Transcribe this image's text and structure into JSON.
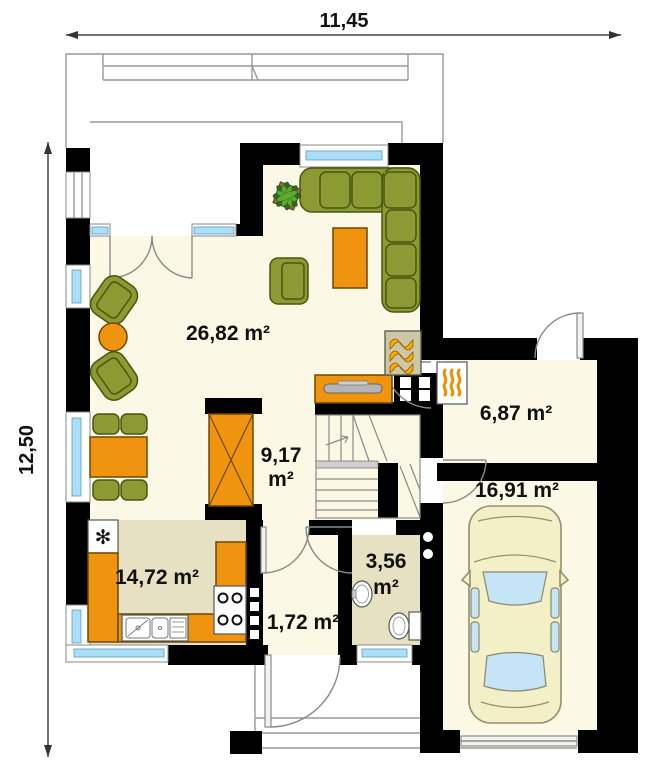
{
  "dimensions": {
    "top": "11,45",
    "left": "12,50"
  },
  "rooms": {
    "living": {
      "label": "26,82 m²"
    },
    "hall": {
      "value": "9,17",
      "unit": "m²"
    },
    "boiler": {
      "label": "6,87 m²"
    },
    "garage": {
      "label": "16,91 m²"
    },
    "kitchen": {
      "label": "14,72 m²"
    },
    "bathroom": {
      "value": "3,56",
      "unit": "m²"
    },
    "vestibule": {
      "label": "1,72 m²"
    }
  },
  "icons": {
    "fridge_snowflake": "✻"
  },
  "colors": {
    "wall": "#000000",
    "floor_light": "#FBF8E5",
    "floor_tan": "#E7E1C3",
    "furniture_green": "#8C9A33",
    "furniture_orange": "#F0930E",
    "window_blue": "#ABDFF5",
    "flame_yellow": "#FFAC00",
    "car_body": "#F3EFC7",
    "car_glass": "#C5E4F6"
  }
}
